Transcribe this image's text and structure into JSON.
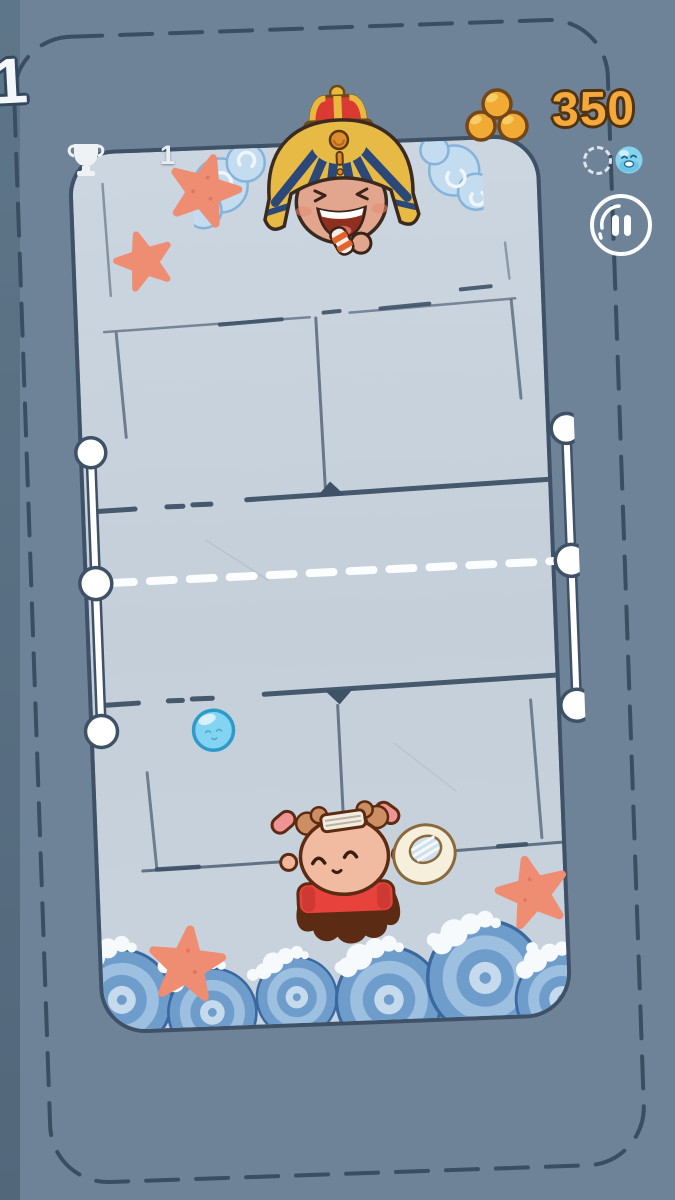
{
  "hud": {
    "level": {
      "label": "1"
    },
    "trophies": {
      "icon": "trophy-icon",
      "count": "1"
    },
    "wallet": {
      "icon": "coins-icon",
      "score": "350"
    },
    "round_indicators": {
      "slot_empty_icon": "dashed-circle-icon",
      "slot_won_icon": "ball-face-icon"
    },
    "pause_icon": "pause-icon"
  },
  "playfield": {
    "opponent": "pharaoh-opponent",
    "player": "player-character",
    "ball": "bubble-ball",
    "net": {
      "posts": 2,
      "knobs_per_post": 3,
      "center_line_style": "white-dashed"
    },
    "decor": {
      "starfish_count": 4,
      "top_splash": true,
      "bottom_surf_waves": true
    }
  },
  "colors": {
    "background": "#6e8398",
    "court_fill": "#c7d1db",
    "line_ink": "#3e5166",
    "score_gold": "#f3a93b",
    "coin_gold": "#f1ab34",
    "starfish": "#ef8d72",
    "ball_blue": "#83d4f2",
    "wave_blue": "#6f9dcb",
    "white": "#f6f9fb"
  }
}
